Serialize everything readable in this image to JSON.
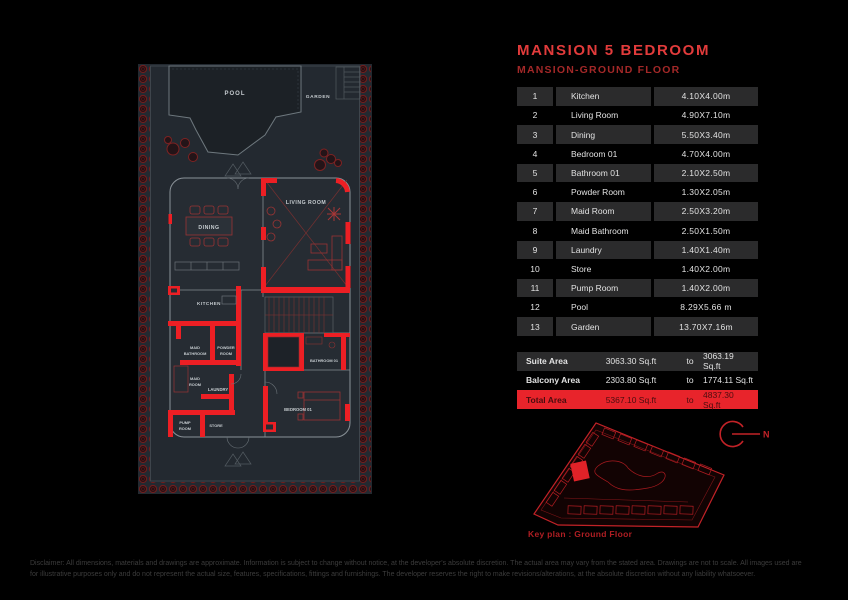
{
  "page": {
    "title": "MANSION 5 BEDROOM",
    "subtitle": "MANSION-GROUND FLOOR"
  },
  "rooms_table": {
    "rows": [
      {
        "num": "1",
        "name": "Kitchen",
        "dim": "4.10X4.00m"
      },
      {
        "num": "2",
        "name": "Living Room",
        "dim": "4.90X7.10m"
      },
      {
        "num": "3",
        "name": "Dining",
        "dim": "5.50X3.40m"
      },
      {
        "num": "4",
        "name": "Bedroom 01",
        "dim": "4.70X4.00m"
      },
      {
        "num": "5",
        "name": "Bathroom 01",
        "dim": "2.10X2.50m"
      },
      {
        "num": "6",
        "name": "Powder Room",
        "dim": "1.30X2.05m"
      },
      {
        "num": "7",
        "name": "Maid Room",
        "dim": "2.50X3.20m"
      },
      {
        "num": "8",
        "name": "Maid Bathroom",
        "dim": "2.50X1.50m"
      },
      {
        "num": "9",
        "name": "Laundry",
        "dim": "1.40X1.40m"
      },
      {
        "num": "10",
        "name": "Store",
        "dim": "1.40X2.00m"
      },
      {
        "num": "11",
        "name": "Pump Room",
        "dim": "1.40X2.00m"
      },
      {
        "num": "12",
        "name": "Pool",
        "dim": "8.29X5.66 m"
      },
      {
        "num": "13",
        "name": "Garden",
        "dim": "13.70X7.16m"
      }
    ]
  },
  "areas_table": {
    "rows": [
      {
        "label": "Suite Area",
        "value_from": "3063.30 Sq.ft",
        "to_word": "to",
        "value_to": "3063.19 Sq.ft"
      },
      {
        "label": "Balcony Area",
        "value_from": "2303.80 Sq.ft",
        "to_word": "to",
        "value_to": "1774.11 Sq.ft"
      },
      {
        "label": "Total Area",
        "value_from": "5367.10 Sq.ft",
        "to_word": "to",
        "value_to": "4837.30 Sq.ft"
      }
    ]
  },
  "plan": {
    "labels": {
      "pool": "POOL",
      "garden": "GARDEN",
      "living": "LIVING ROOM",
      "dining": "DINING",
      "kitchen": "KITCHEN",
      "maid_bath_1": "MAID",
      "maid_bath_2": "BATHROOM",
      "powder_1": "POWDER",
      "powder_2": "ROOM",
      "maid_room_1": "MAID",
      "maid_room_2": "ROOM",
      "laundry": "LAUNDRY",
      "pump_1": "PUMP",
      "pump_2": "ROOM",
      "store": "STORE",
      "bathroom01": "BATHROOM 01",
      "bedroom01": "BEDROOM 01"
    }
  },
  "keyplan": {
    "caption": "Key plan : Ground Floor",
    "north_label": "N"
  },
  "disclaimer": {
    "line1": "Disclaimer: All dimensions, materials and drawings are approximate. Information is subject to change without notice, at the developer's absolute discretion. The actual area may vary from the stated area. Drawings are not to scale. All images used are",
    "line2": "for illustrative purposes only and do not represent the actual size, features, specifications, fittings and furnishings. The developer reserves the right to make revisions/alterations, at the absolute discretion without any liability whatsoever."
  },
  "colors": {
    "accent_wall_red": "#ed1f24",
    "title_red": "#e23b3b",
    "subtitle_red": "#a32828",
    "total_row_bg": "#e8242b",
    "alt_row_bg": "#2b2b2c",
    "plan_bg": "#232930"
  }
}
